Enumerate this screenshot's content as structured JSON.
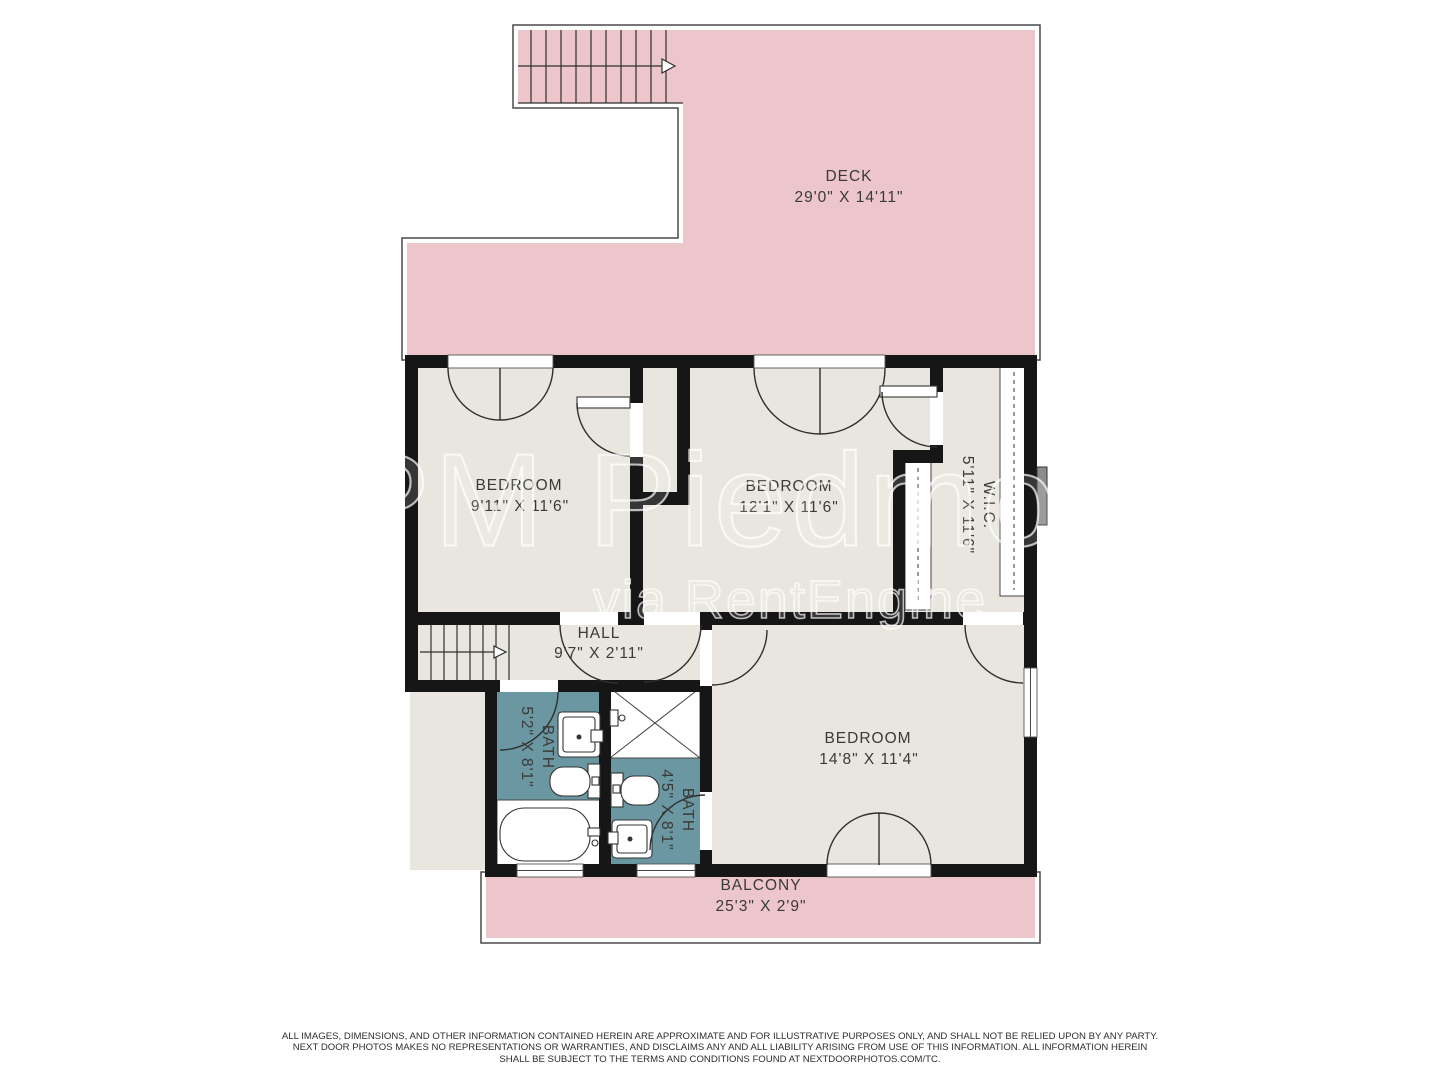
{
  "plan": {
    "rooms": {
      "deck": {
        "name": "DECK",
        "dims": "29'0\" X 14'11\""
      },
      "bedroom1": {
        "name": "BEDROOM",
        "dims": "9'11\" X 11'6\""
      },
      "bedroom2": {
        "name": "BEDROOM",
        "dims": "12'1\" X 11'6\""
      },
      "wic": {
        "name": "W.I.C.",
        "dims": "5'11\" X 11'6\""
      },
      "hall": {
        "name": "HALL",
        "dims": "9'7\" X 2'11\""
      },
      "bath1": {
        "name": "BATH",
        "dims": "5'2\" X 8'1\""
      },
      "bath2": {
        "name": "BATH",
        "dims": "4'5\" X 8'1\""
      },
      "bedroom3": {
        "name": "BEDROOM",
        "dims": "14'8\" X 11'4\""
      },
      "balcony": {
        "name": "BALCONY",
        "dims": "25'3\" X 2'9\""
      }
    },
    "watermark": {
      "line1": "PM Piedmont",
      "line2": "via RentEngine"
    },
    "footer": {
      "line1": "ALL IMAGES, DIMENSIONS, AND OTHER INFORMATION CONTAINED HEREIN ARE APPROXIMATE AND FOR ILLUSTRATIVE PURPOSES ONLY, AND SHALL NOT BE RELIED UPON BY ANY PARTY.",
      "line2": "NEXT DOOR PHOTOS MAKES NO REPRESENTATIONS OR WARRANTIES, AND DISCLAIMS ANY AND ALL LIABILITY ARISING FROM USE OF THIS INFORMATION. ALL INFORMATION HEREIN",
      "line3": "SHALL BE SUBJECT TO THE TERMS AND CONDITIONS FOUND AT NEXTDOORPHOTOS.COM/TC."
    },
    "colors": {
      "outdoor": "#ecc6ca",
      "floor": "#e8e6de",
      "bath": "#6a97a2",
      "wall": "#161616"
    }
  }
}
